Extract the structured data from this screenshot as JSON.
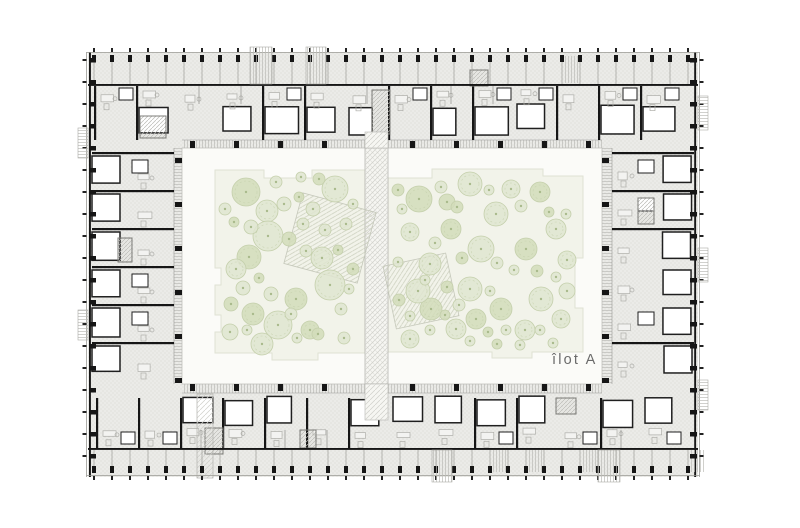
{
  "plan": {
    "label": "îlot A",
    "seed": 9,
    "canvas": {
      "w": 800,
      "h": 528
    },
    "colors": {
      "paper": "#ffffff",
      "stipple_bg": "#ebebe8",
      "stipple_dot": "#d2d2ce",
      "wall": "#161616",
      "line": "#9a9a95",
      "divider": "#a8a8a3",
      "room_fill": "#ffffff",
      "room_stroke": "#1f1f1f",
      "furn": "#aeaea9",
      "walk_hatch": "#bcbcb7",
      "court_bg": "#fbfbf8",
      "court_border": "#c2c2bd",
      "lawn": "#f2f3ea",
      "lawn_border": "#dfe2d3",
      "tree_fill": "#dfe5d0",
      "tree_fill_dark": "#d2dcba",
      "tree_stroke": "#c4cfab",
      "tree_dot": "#a9ba8c",
      "path_hatch": "#cfcfca",
      "play_hatch": "#c9cdbb",
      "label_color": "#6b6b6b"
    },
    "building": {
      "x": 88,
      "y": 52,
      "w": 610,
      "h": 425
    },
    "courtyard": {
      "x": 182,
      "y": 148,
      "w": 420,
      "h": 236
    },
    "walkways": {
      "top": [
        182,
        140,
        420,
        8
      ],
      "bottom": [
        182,
        384,
        420,
        9
      ],
      "left": [
        174,
        148,
        8,
        236
      ],
      "right": [
        602,
        148,
        10,
        236
      ]
    },
    "strip": {
      "x": 365,
      "y": 148,
      "w": 23,
      "h": 236,
      "stubs": [
        [
          365,
          132,
          23,
          16
        ],
        [
          365,
          384,
          23,
          36
        ]
      ]
    },
    "lawns": [
      {
        "points": [
          [
            215,
            170
          ],
          [
            264,
            170
          ],
          [
            264,
            178
          ],
          [
            312,
            178
          ],
          [
            312,
            170
          ],
          [
            365,
            170
          ],
          [
            365,
            353
          ],
          [
            318,
            353
          ],
          [
            318,
            360
          ],
          [
            272,
            360
          ],
          [
            272,
            353
          ],
          [
            215,
            353
          ],
          [
            215,
            332
          ],
          [
            221,
            332
          ],
          [
            221,
            315
          ],
          [
            215,
            315
          ],
          [
            215,
            285
          ],
          [
            221,
            285
          ],
          [
            221,
            268
          ],
          [
            215,
            268
          ]
        ]
      },
      {
        "points": [
          [
            388,
            178
          ],
          [
            432,
            178
          ],
          [
            432,
            169
          ],
          [
            543,
            169
          ],
          [
            543,
            176
          ],
          [
            583,
            176
          ],
          [
            583,
            258
          ],
          [
            575,
            258
          ],
          [
            575,
            308
          ],
          [
            583,
            308
          ],
          [
            583,
            352
          ],
          [
            532,
            352
          ],
          [
            532,
            358
          ],
          [
            492,
            358
          ],
          [
            492,
            352
          ],
          [
            388,
            352
          ]
        ]
      }
    ],
    "play_areas": [
      {
        "cx": 330,
        "cy": 238,
        "w": 76,
        "h": 73,
        "rot": 15
      },
      {
        "cx": 421,
        "cy": 291,
        "w": 64,
        "h": 64,
        "rot": -12
      }
    ],
    "trees": [
      [
        246,
        192,
        14
      ],
      [
        267,
        211,
        11
      ],
      [
        268,
        236,
        15
      ],
      [
        249,
        257,
        12
      ],
      [
        236,
        269,
        10
      ],
      [
        278,
        325,
        14
      ],
      [
        253,
        314,
        11
      ],
      [
        335,
        189,
        13
      ],
      [
        330,
        285,
        15
      ],
      [
        296,
        299,
        11
      ],
      [
        322,
        258,
        11
      ],
      [
        262,
        344,
        11
      ],
      [
        310,
        330,
        9
      ],
      [
        230,
        332,
        8
      ],
      [
        225,
        209,
        6
      ],
      [
        234,
        222,
        5
      ],
      [
        251,
        227,
        7
      ],
      [
        284,
        204,
        7
      ],
      [
        299,
        197,
        5
      ],
      [
        313,
        209,
        7
      ],
      [
        303,
        224,
        6
      ],
      [
        289,
        239,
        7
      ],
      [
        306,
        251,
        6
      ],
      [
        243,
        288,
        7
      ],
      [
        259,
        278,
        5
      ],
      [
        271,
        294,
        7
      ],
      [
        291,
        314,
        6
      ],
      [
        318,
        334,
        6
      ],
      [
        297,
        338,
        5
      ],
      [
        247,
        330,
        5
      ],
      [
        231,
        304,
        7
      ],
      [
        341,
        309,
        6
      ],
      [
        349,
        289,
        5
      ],
      [
        353,
        269,
        6
      ],
      [
        346,
        224,
        6
      ],
      [
        353,
        204,
        5
      ],
      [
        319,
        179,
        6
      ],
      [
        301,
        177,
        5
      ],
      [
        276,
        182,
        6
      ],
      [
        338,
        250,
        5
      ],
      [
        325,
        230,
        6
      ],
      [
        344,
        338,
        6
      ],
      [
        419,
        199,
        13
      ],
      [
        470,
        184,
        12
      ],
      [
        496,
        214,
        12
      ],
      [
        451,
        229,
        10
      ],
      [
        481,
        249,
        13
      ],
      [
        430,
        264,
        11
      ],
      [
        526,
        249,
        11
      ],
      [
        556,
        229,
        10
      ],
      [
        470,
        289,
        12
      ],
      [
        501,
        309,
        11
      ],
      [
        541,
        299,
        12
      ],
      [
        561,
        319,
        9
      ],
      [
        431,
        309,
        11
      ],
      [
        456,
        329,
        10
      ],
      [
        511,
        189,
        9
      ],
      [
        540,
        192,
        10
      ],
      [
        410,
        232,
        9
      ],
      [
        418,
        291,
        12
      ],
      [
        476,
        319,
        10
      ],
      [
        525,
        330,
        10
      ],
      [
        410,
        339,
        9
      ],
      [
        447,
        202,
        8
      ],
      [
        567,
        260,
        9
      ],
      [
        567,
        291,
        8
      ],
      [
        398,
        190,
        6
      ],
      [
        402,
        209,
        5
      ],
      [
        441,
        187,
        6
      ],
      [
        457,
        207,
        6
      ],
      [
        489,
        190,
        5
      ],
      [
        521,
        206,
        6
      ],
      [
        549,
        212,
        5
      ],
      [
        566,
        214,
        5
      ],
      [
        435,
        243,
        6
      ],
      [
        462,
        258,
        6
      ],
      [
        497,
        263,
        6
      ],
      [
        514,
        270,
        5
      ],
      [
        537,
        271,
        6
      ],
      [
        556,
        277,
        5
      ],
      [
        425,
        280,
        5
      ],
      [
        447,
        287,
        6
      ],
      [
        490,
        291,
        5
      ],
      [
        459,
        305,
        6
      ],
      [
        488,
        332,
        5
      ],
      [
        506,
        330,
        5
      ],
      [
        540,
        330,
        5
      ],
      [
        445,
        315,
        5
      ],
      [
        430,
        330,
        5
      ],
      [
        470,
        341,
        5
      ],
      [
        497,
        344,
        5
      ],
      [
        520,
        345,
        5
      ],
      [
        398,
        262,
        5
      ],
      [
        399,
        300,
        6
      ],
      [
        410,
        316,
        5
      ],
      [
        553,
        343,
        5
      ]
    ],
    "cores": [
      [
        140,
        116,
        26,
        22
      ],
      [
        372,
        90,
        18,
        44
      ],
      [
        205,
        428,
        18,
        26
      ],
      [
        556,
        398,
        20,
        16
      ],
      [
        638,
        198,
        16,
        26
      ],
      [
        118,
        238,
        14,
        24
      ],
      [
        470,
        70,
        18,
        16
      ],
      [
        300,
        430,
        16,
        18
      ]
    ],
    "entrances": [
      [
        197,
        394,
        16,
        84
      ]
    ],
    "protrusions": {
      "top": [
        [
          250,
          22
        ],
        [
          306,
          20
        ]
      ],
      "bottom": [
        [
          432,
          20
        ],
        [
          598,
          22
        ]
      ],
      "left": [
        [
          128,
          30
        ],
        [
          310,
          30
        ]
      ],
      "right": [
        [
          96,
          34
        ],
        [
          248,
          34
        ],
        [
          380,
          30
        ]
      ]
    },
    "combs": {
      "edge_spacing": 18,
      "side_spacing": 22
    },
    "modules": {
      "top_step": 42,
      "side_step": 38
    }
  }
}
